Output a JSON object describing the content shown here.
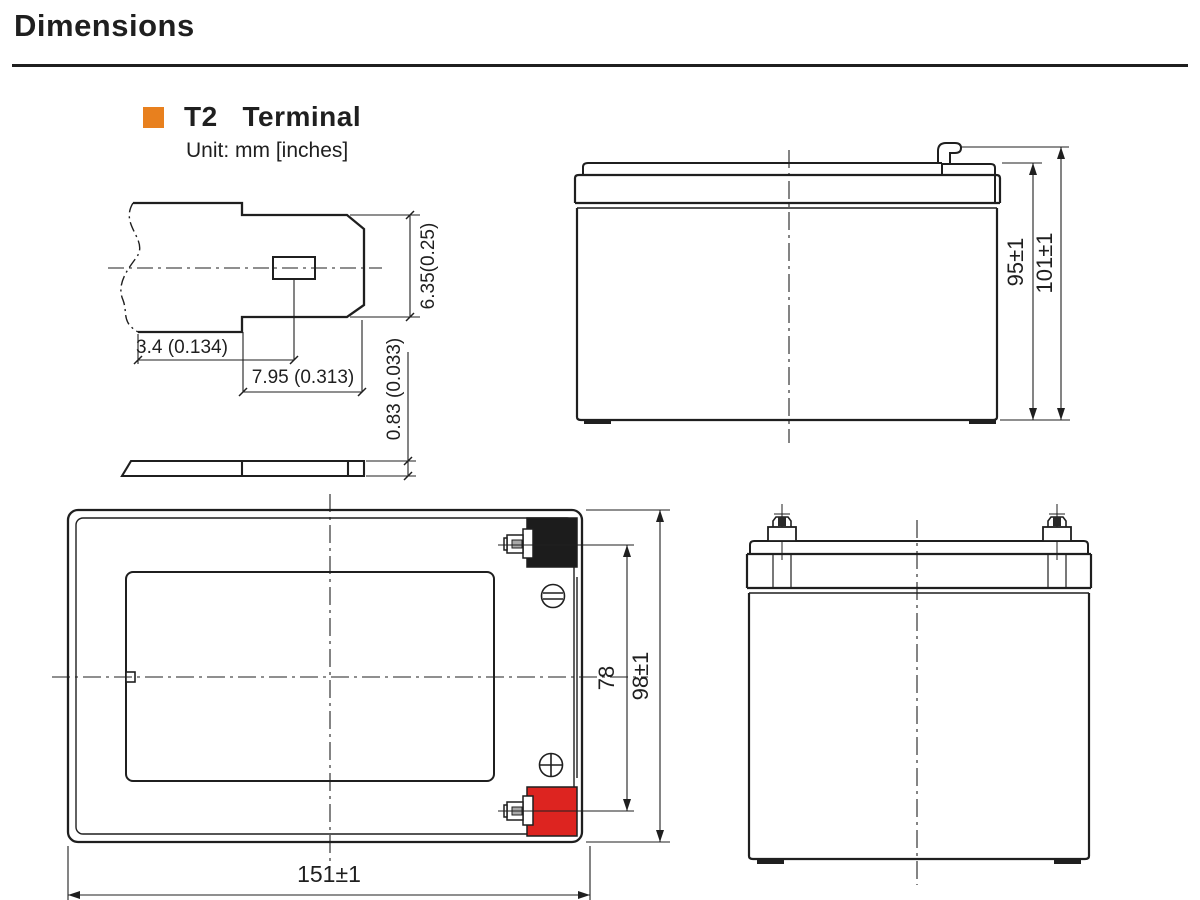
{
  "page_title": "Dimensions",
  "section": {
    "title": "T2   Terminal",
    "unit_label": "Unit: mm [inches]",
    "bullet_color": "#e8801e"
  },
  "terminal_detail": {
    "dims": {
      "tab_width": "6.35(0.25)",
      "hole_offset": "3.4 (0.134)",
      "hole_to_tip": "7.95 (0.313)",
      "thickness": "0.83 (0.033)"
    }
  },
  "side_view": {
    "dims": {
      "container_height": "95±1",
      "total_height": "101±1"
    }
  },
  "top_view": {
    "dims": {
      "terminal_pitch": "78",
      "width": "98±1",
      "length": "151±1"
    },
    "terminals": {
      "negative": {
        "polarity": "negative",
        "color": "#1c1c1c"
      },
      "positive": {
        "polarity": "positive",
        "color": "#dd2420"
      }
    }
  },
  "colors": {
    "line": "#1f1f1f",
    "accent": "#e8801e"
  }
}
